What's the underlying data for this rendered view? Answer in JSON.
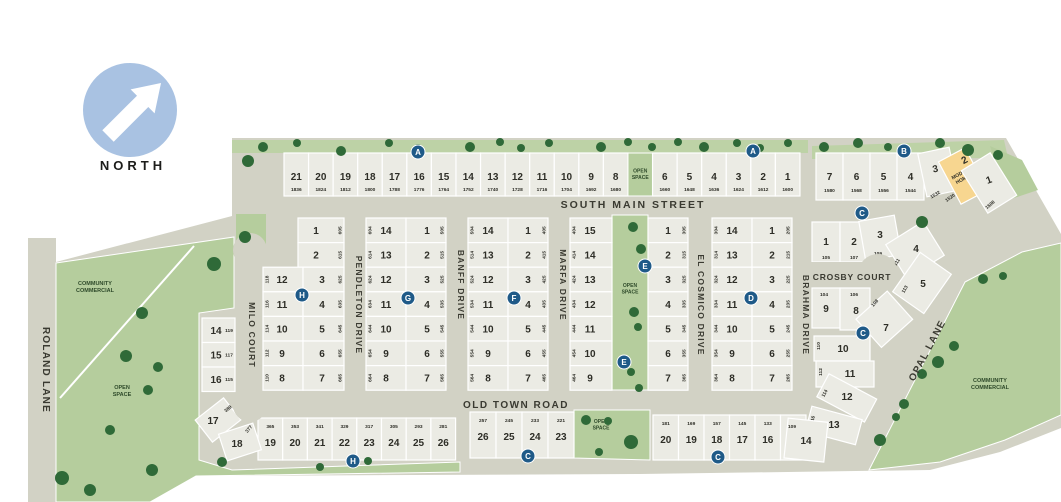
{
  "north": {
    "label": "NORTH"
  },
  "colors": {
    "land": "#d2d2c5",
    "lot": "#ebebe4",
    "green": "#b5cd9d",
    "green_band": "#bdd2a6",
    "tree": "#2f6a38",
    "marker_blue": "#1f5a88",
    "model_home_yellow": "#f7d690",
    "north_circle": "#a9c2e2"
  },
  "streets": {
    "south_main": "SOUTH MAIN STREET",
    "old_town": "OLD TOWN ROAD",
    "roland": "ROLAND LANE",
    "milo": "MILO COURT",
    "pendleton": "PENDLETON DRIVE",
    "banff": "BANFF DRIVE",
    "marfa": "MARFA DRIVE",
    "el_cosmico": "EL COSMICO DRIVE",
    "brahma": "BRAHMA DRIVE",
    "crosby": "CROSBY COURT",
    "opal": "OPAL LANE"
  },
  "areas": {
    "open_space": "OPEN SPACE",
    "community_commercial": "COMMUNITY COMMERCIAL"
  },
  "model_home": {
    "label_lines": [
      "MODEL",
      "HOME"
    ]
  },
  "legend_markers": [
    {
      "letter": "A",
      "x": 418,
      "y": 152
    },
    {
      "letter": "A",
      "x": 753,
      "y": 151
    },
    {
      "letter": "B",
      "x": 904,
      "y": 151
    },
    {
      "letter": "C",
      "x": 862,
      "y": 213
    },
    {
      "letter": "C",
      "x": 863,
      "y": 333
    },
    {
      "letter": "C",
      "x": 528,
      "y": 456
    },
    {
      "letter": "C",
      "x": 718,
      "y": 457
    },
    {
      "letter": "D",
      "x": 751,
      "y": 298
    },
    {
      "letter": "E",
      "x": 645,
      "y": 266
    },
    {
      "letter": "E",
      "x": 624,
      "y": 362
    },
    {
      "letter": "F",
      "x": 514,
      "y": 298
    },
    {
      "letter": "G",
      "x": 408,
      "y": 298
    },
    {
      "letter": "H",
      "x": 302,
      "y": 295
    },
    {
      "letter": "H",
      "x": 353,
      "y": 461
    }
  ],
  "blocks": {
    "top_row": [
      {
        "lot": "21",
        "address": "1836"
      },
      {
        "lot": "20",
        "address": "1824"
      },
      {
        "lot": "19",
        "address": "1812"
      },
      {
        "lot": "18",
        "address": "1800"
      },
      {
        "lot": "17",
        "address": "1788"
      },
      {
        "lot": "16",
        "address": "1776"
      },
      {
        "lot": "15",
        "address": "1764"
      },
      {
        "lot": "14",
        "address": "1752"
      },
      {
        "lot": "13",
        "address": "1740"
      },
      {
        "lot": "12",
        "address": "1728"
      },
      {
        "lot": "11",
        "address": "1716"
      },
      {
        "lot": "10",
        "address": "1704"
      },
      {
        "lot": "9",
        "address": "1692"
      },
      {
        "lot": "8",
        "address": "1680"
      },
      {
        "open_space": true
      },
      {
        "lot": "6",
        "address": "1660"
      },
      {
        "lot": "5",
        "address": "1648"
      },
      {
        "lot": "4",
        "address": "1636"
      },
      {
        "lot": "3",
        "address": "1624"
      },
      {
        "lot": "2",
        "address": "1612"
      },
      {
        "lot": "1",
        "address": "1600"
      }
    ],
    "top_east_row": [
      {
        "lot": "7",
        "address": "1580"
      },
      {
        "lot": "6",
        "address": "1568"
      },
      {
        "lot": "5",
        "address": "1556"
      },
      {
        "lot": "4",
        "address": "1544"
      },
      {
        "lot": "3",
        "address": "1532"
      },
      {
        "lot": "2",
        "address": "1520",
        "model_home": true
      },
      {
        "lot": "1",
        "address": "1508"
      }
    ],
    "milo_west": [
      {
        "lot": "14",
        "address": "119"
      },
      {
        "lot": "15",
        "address": "117"
      },
      {
        "lot": "16",
        "address": "115"
      }
    ],
    "milo_sw_curve": [
      {
        "lot": "17",
        "address": "389"
      },
      {
        "lot": "18",
        "address": "377"
      }
    ],
    "milo_block_full": [
      {
        "lot": "1",
        "address": "605"
      },
      {
        "lot": "2",
        "address": "615"
      }
    ],
    "milo_block_left": [
      {
        "lot": "12",
        "address": "118"
      },
      {
        "lot": "11",
        "address": "116"
      },
      {
        "lot": "10",
        "address": "114"
      },
      {
        "lot": "9",
        "address": "112"
      },
      {
        "lot": "8",
        "address": "110"
      }
    ],
    "milo_block_right": [
      {
        "lot": "3",
        "address": "625"
      },
      {
        "lot": "4",
        "address": "635"
      },
      {
        "lot": "5",
        "address": "645"
      },
      {
        "lot": "6",
        "address": "655"
      },
      {
        "lot": "7",
        "address": "665"
      }
    ],
    "pendleton_banff_left": [
      {
        "lot": "14",
        "address": "604"
      },
      {
        "lot": "13",
        "address": "614"
      },
      {
        "lot": "12",
        "address": "624"
      },
      {
        "lot": "11",
        "address": "634"
      },
      {
        "lot": "10",
        "address": "644"
      },
      {
        "lot": "9",
        "address": "654"
      },
      {
        "lot": "8",
        "address": "664"
      }
    ],
    "pendleton_banff_right": [
      {
        "lot": "1",
        "address": "505"
      },
      {
        "lot": "2",
        "address": "515"
      },
      {
        "lot": "3",
        "address": "525"
      },
      {
        "lot": "4",
        "address": "535"
      },
      {
        "lot": "5",
        "address": "545"
      },
      {
        "lot": "6",
        "address": "555"
      },
      {
        "lot": "7",
        "address": "565"
      }
    ],
    "banff_marfa_left": [
      {
        "lot": "14",
        "address": "504"
      },
      {
        "lot": "13",
        "address": "514"
      },
      {
        "lot": "12",
        "address": "524"
      },
      {
        "lot": "11",
        "address": "534"
      },
      {
        "lot": "10",
        "address": "544"
      },
      {
        "lot": "9",
        "address": "554"
      },
      {
        "lot": "8",
        "address": "564"
      }
    ],
    "banff_marfa_right": [
      {
        "lot": "1",
        "address": "405"
      },
      {
        "lot": "2",
        "address": "415"
      },
      {
        "lot": "3",
        "address": "425"
      },
      {
        "lot": "4",
        "address": "435"
      },
      {
        "lot": "5",
        "address": "445"
      },
      {
        "lot": "6",
        "address": "455"
      },
      {
        "lot": "7",
        "address": "465"
      }
    ],
    "marfa_open_left": [
      {
        "lot": "15",
        "address": "404"
      },
      {
        "lot": "14",
        "address": "414"
      },
      {
        "lot": "13",
        "address": "424"
      },
      {
        "lot": "12",
        "address": "434"
      },
      {
        "lot": "11",
        "address": "444"
      },
      {
        "lot": "10",
        "address": "454"
      },
      {
        "lot": "9",
        "address": "464"
      }
    ],
    "open_cosmico_right": [
      {
        "lot": "1",
        "address": "305"
      },
      {
        "lot": "2",
        "address": "315"
      },
      {
        "lot": "3",
        "address": "325"
      },
      {
        "lot": "4",
        "address": "335"
      },
      {
        "lot": "5",
        "address": "345"
      },
      {
        "lot": "6",
        "address": "355"
      },
      {
        "lot": "7",
        "address": "365"
      }
    ],
    "cosmico_brahma_left": [
      {
        "lot": "14",
        "address": "304"
      },
      {
        "lot": "13",
        "address": "314"
      },
      {
        "lot": "12",
        "address": "324"
      },
      {
        "lot": "11",
        "address": "334"
      },
      {
        "lot": "10",
        "address": "344"
      },
      {
        "lot": "9",
        "address": "354"
      },
      {
        "lot": "8",
        "address": "364"
      }
    ],
    "cosmico_brahma_right": [
      {
        "lot": "1",
        "address": "205"
      },
      {
        "lot": "2",
        "address": "215"
      },
      {
        "lot": "3",
        "address": "225"
      },
      {
        "lot": "4",
        "address": "235"
      },
      {
        "lot": "5",
        "address": "245"
      },
      {
        "lot": "6",
        "address": "255"
      },
      {
        "lot": "7",
        "address": "265"
      }
    ],
    "bottom_west": [
      {
        "lot": "19",
        "address": "365"
      },
      {
        "lot": "20",
        "address": "353"
      },
      {
        "lot": "21",
        "address": "341"
      },
      {
        "lot": "22",
        "address": "329"
      },
      {
        "lot": "23",
        "address": "317"
      },
      {
        "lot": "24",
        "address": "305"
      },
      {
        "lot": "25",
        "address": "293"
      },
      {
        "lot": "26",
        "address": "281"
      }
    ],
    "bottom_mid": [
      {
        "lot": "26",
        "address": "257"
      },
      {
        "lot": "25",
        "address": "245"
      },
      {
        "lot": "24",
        "address": "233"
      },
      {
        "lot": "23",
        "address": "221"
      }
    ],
    "bottom_east": [
      {
        "lot": "20",
        "address": "181"
      },
      {
        "lot": "19",
        "address": "169"
      },
      {
        "lot": "18",
        "address": "157"
      },
      {
        "lot": "17",
        "address": "145"
      },
      {
        "lot": "16",
        "address": "133"
      },
      {
        "lot": "15",
        "address": "121"
      }
    ],
    "bottom_east_curve": [
      {
        "lot": "14",
        "address": "109"
      },
      {
        "lot": "13",
        "address": "116"
      },
      {
        "lot": "12",
        "address": "114"
      }
    ],
    "crosby_north": [
      {
        "lot": "1",
        "address": "105"
      },
      {
        "lot": "2",
        "address": "107"
      },
      {
        "lot": "3",
        "address": "109"
      },
      {
        "lot": "4",
        "address": "111"
      },
      {
        "lot": "5",
        "address": "113"
      }
    ],
    "crosby_south": [
      {
        "lot": "9",
        "address": "104"
      },
      {
        "lot": "8",
        "address": "106"
      },
      {
        "lot": "7",
        "address": "108"
      }
    ],
    "brahma_east": [
      {
        "lot": "10",
        "address": "110"
      },
      {
        "lot": "11",
        "address": "112"
      }
    ]
  }
}
